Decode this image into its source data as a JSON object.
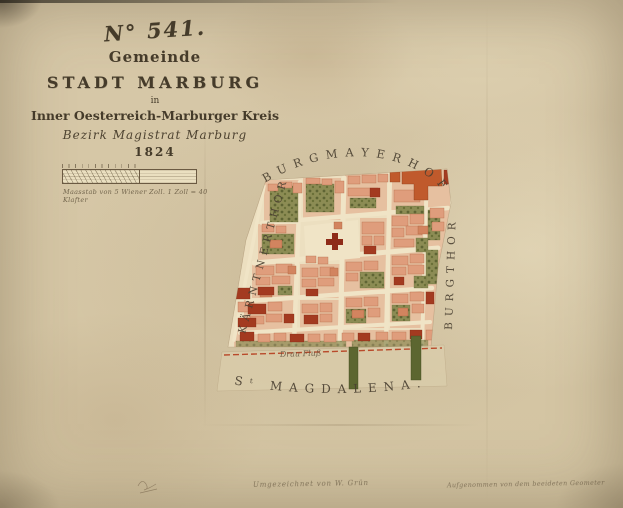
{
  "title": {
    "sheet_number": "N° 541.",
    "gemeinde": "Gemeinde",
    "city": "STADT MARBURG",
    "in_word": "in",
    "kreis": "Inner Oesterreich-Marburger Kreis",
    "bezirk": "Bezirk Magistrat Marburg",
    "year": "1824"
  },
  "scale_bar": {
    "caption": "Maasstab von 5 Wiener Zoll.   1 Zoll = 40 Klafter"
  },
  "map": {
    "label_top": "BURGMAYERHOF",
    "label_left": "KÄRNTNERTHOR",
    "label_right": "BURGTHOR",
    "label_bottom": "Sᵗ MAGDALENA.",
    "river": "Drau Fluß"
  },
  "notes": {
    "center": "Umgezeichnet von W. Grün",
    "right": "Aufgenommen von dem beeideten Geometer"
  },
  "colors": {
    "paper": "#d7c8a8",
    "building_salmon": "#df9d7c",
    "building_red": "#a33a20",
    "castle_orange": "#c05a2c",
    "garden_green": "#8c8c54",
    "street_cream": "#f0e4c6",
    "boundary_red_line": "#b94a2b",
    "ink": "#453b2a"
  }
}
